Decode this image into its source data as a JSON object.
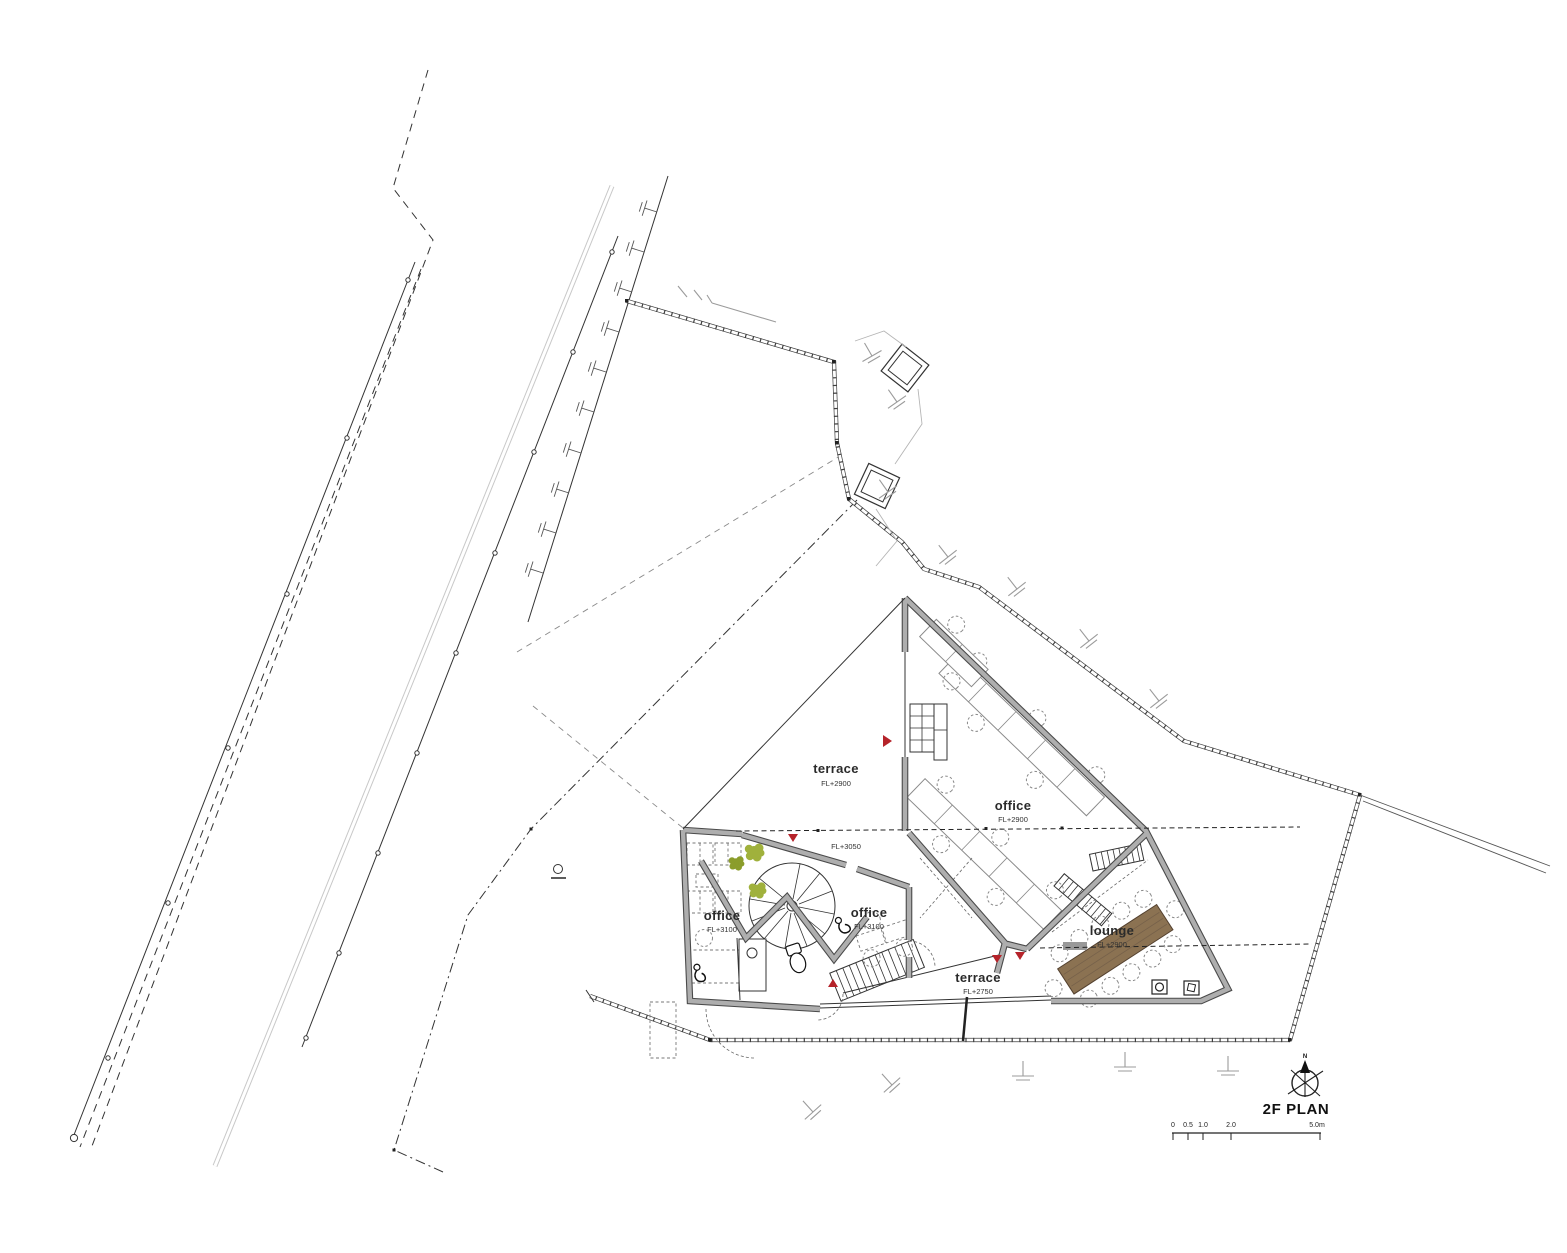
{
  "plan": {
    "title": "2F PLAN",
    "north_label": "N",
    "datum_label": "FL+3050",
    "rooms": [
      {
        "name": "terrace",
        "level": "FL+2900"
      },
      {
        "name": "office",
        "level": "FL+2900"
      },
      {
        "name": "office",
        "level": "FL+3100"
      },
      {
        "name": "office",
        "level": "FL+3100"
      },
      {
        "name": "lounge",
        "level": "FL+2900"
      },
      {
        "name": "terrace",
        "level": "FL+2750"
      }
    ],
    "scale_bar": {
      "tick_labels": [
        "0",
        "0.5",
        "1.0",
        "2.0",
        "5.0m"
      ]
    },
    "colors": {
      "wall_gray": "#aeaeae",
      "wall_edge": "#4a4a4a",
      "marker_red": "#b5232a",
      "wood_brown": "#8b7252",
      "tree_green": "#a0b13c",
      "site_line_gray": "#9b9b9b"
    }
  }
}
